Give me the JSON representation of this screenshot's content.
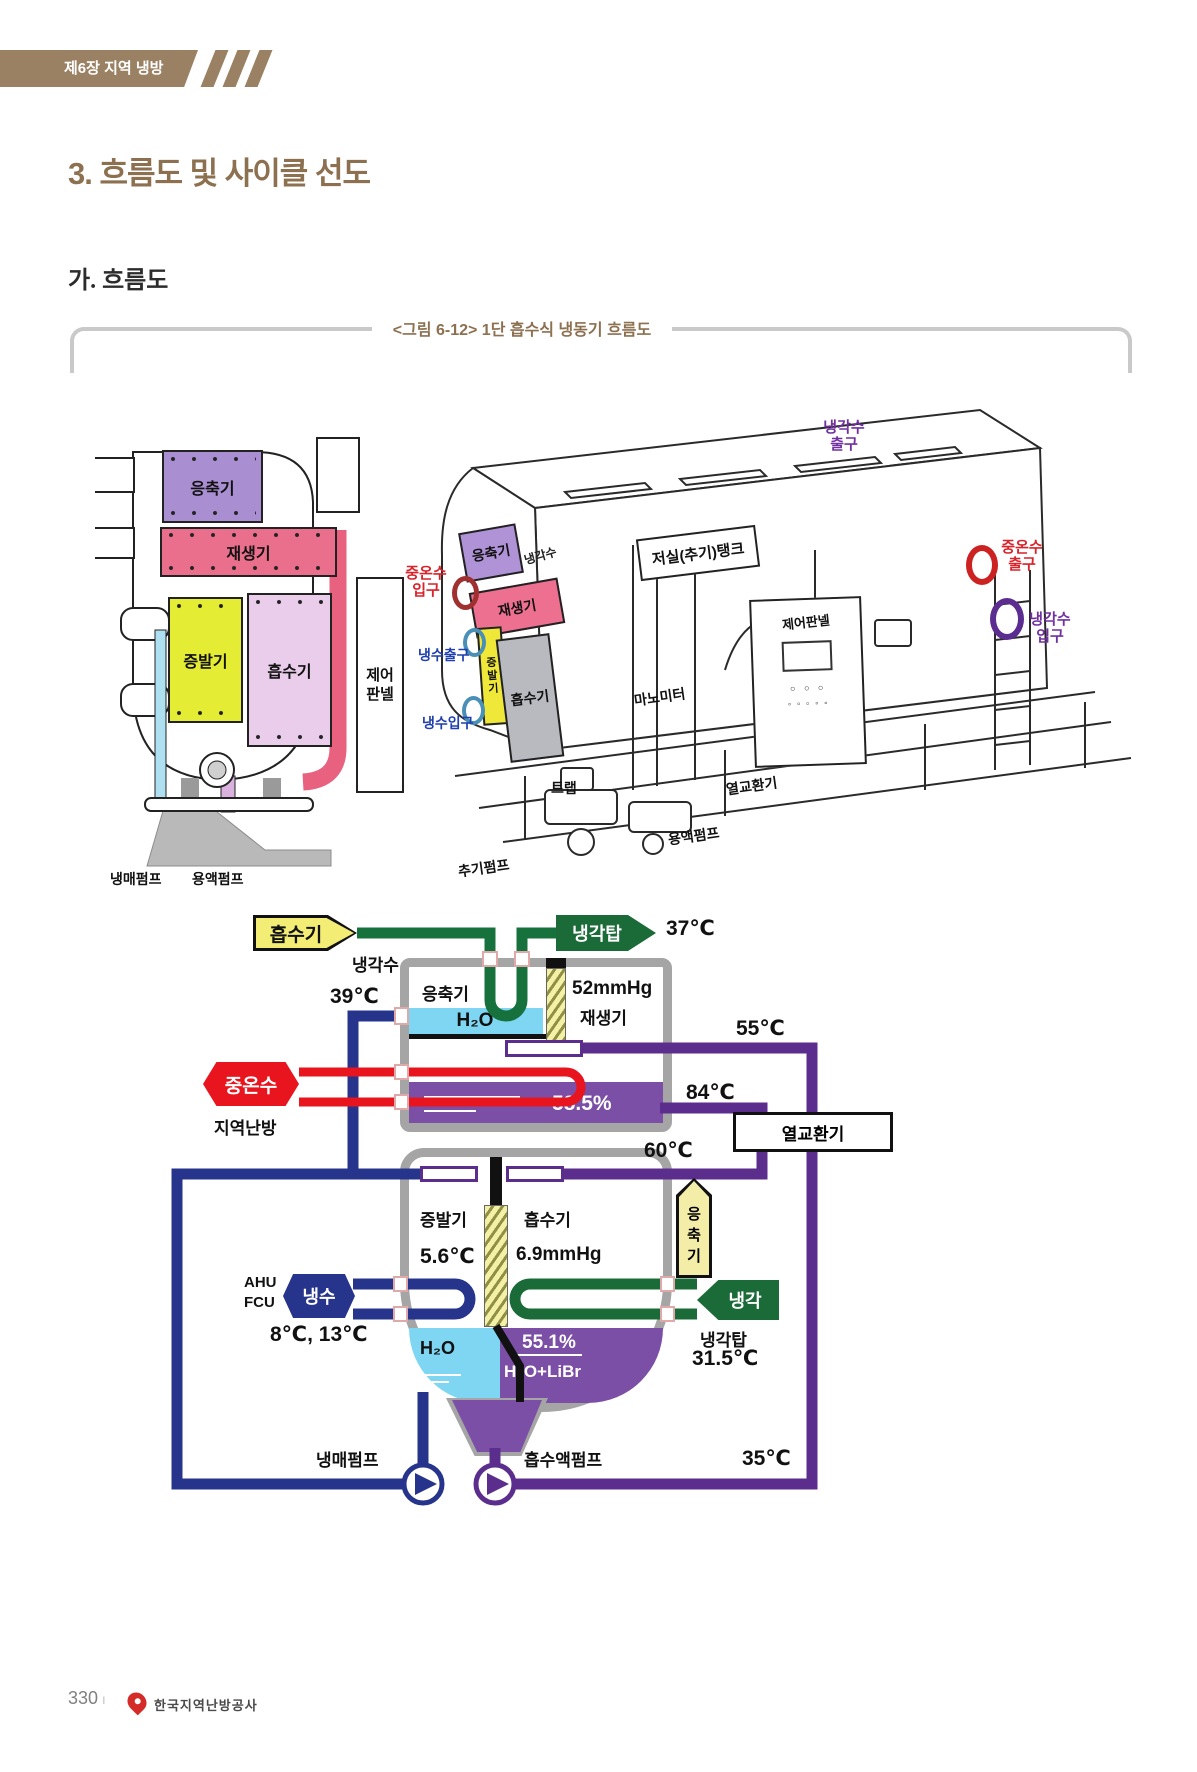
{
  "page": {
    "chapter": "제6장 지역 냉방",
    "title": "3. 흐름도 및 사이클 선도",
    "section": "가. 흐름도",
    "caption": "<그림 6-12> 1단 흡수식 냉동기 흐름도",
    "page_number": "330",
    "publisher": "한국지역난방공사"
  },
  "left_view": {
    "condenser": "응축기",
    "regenerator": "재생기",
    "evaporator": "증발기",
    "absorber": "흡수기",
    "control_panel": "제어 판넬",
    "refrigerant_pump": "냉매펌프",
    "solution_pump": "용액펌프"
  },
  "right_view": {
    "coolant_outlet": "냉각수 출구",
    "condenser": "응축기",
    "coolant": "냉각수",
    "storage_tank": "저실(추기)탱크",
    "hot_water_inlet": "중온수 입구",
    "regenerator": "재생기",
    "chilled_water_outlet": "냉수출구",
    "evaporator": "증발기",
    "chilled_water_inlet": "냉수입구",
    "absorber": "흡수기",
    "manometer": "마노미터",
    "control_panel": "제어판넬",
    "trap": "트랩",
    "heat_exchanger": "열교환기",
    "solution_pump": "용액펌프",
    "purge_pump": "추기펌프",
    "hot_water_outlet": "중온수 출구",
    "coolant_inlet": "냉각수 입구"
  },
  "flow": {
    "from_absorber": "흡수기",
    "cooling_water": "냉각수",
    "to_cooling_tower": "냉각탑",
    "t37": "37℃",
    "condenser": "응축기",
    "h2o": "H₂O",
    "p52": "52mmHg",
    "regenerator": "재생기",
    "t39": "39℃",
    "t55": "55℃",
    "hot_water": "중온수",
    "district_heating": "지역난방",
    "conc_strong": "58.5%",
    "t84": "84℃",
    "heat_exchanger": "열교환기",
    "t60": "60℃",
    "evaporator": "증발기",
    "t5_6": "5.6℃",
    "absorber": "흡수기",
    "p6_9": "6.9mmHg",
    "to_condenser": "응축기",
    "chilled_water": "냉수",
    "ahu": "AHU",
    "fcu": "FCU",
    "t8_13": "8℃, 13℃",
    "cooling": "냉각",
    "cooling_tower": "냉각탑",
    "t31_5": "31.5℃",
    "h2o_pool": "H₂O",
    "conc_weak": "55.1%",
    "solution": "H₂O+LiBr",
    "refrigerant_pump": "냉매펌프",
    "absorbent_pump": "흡수액펌프",
    "t35": "35℃"
  },
  "colors": {
    "brown_title": "#8c7050",
    "banner_brown": "#9b8163",
    "green_pipe": "#17713c",
    "green_arrow": "#1a6b38",
    "yellow_arrow": "#f3ec75",
    "navy_pipe": "#27348b",
    "red_pipe": "#e8141e",
    "purple_pipe": "#5b2e8e",
    "purple_solution": "#7b4fa6",
    "cyan_water": "#7fd6f2",
    "vessel_wall": "#a5a5a5"
  }
}
